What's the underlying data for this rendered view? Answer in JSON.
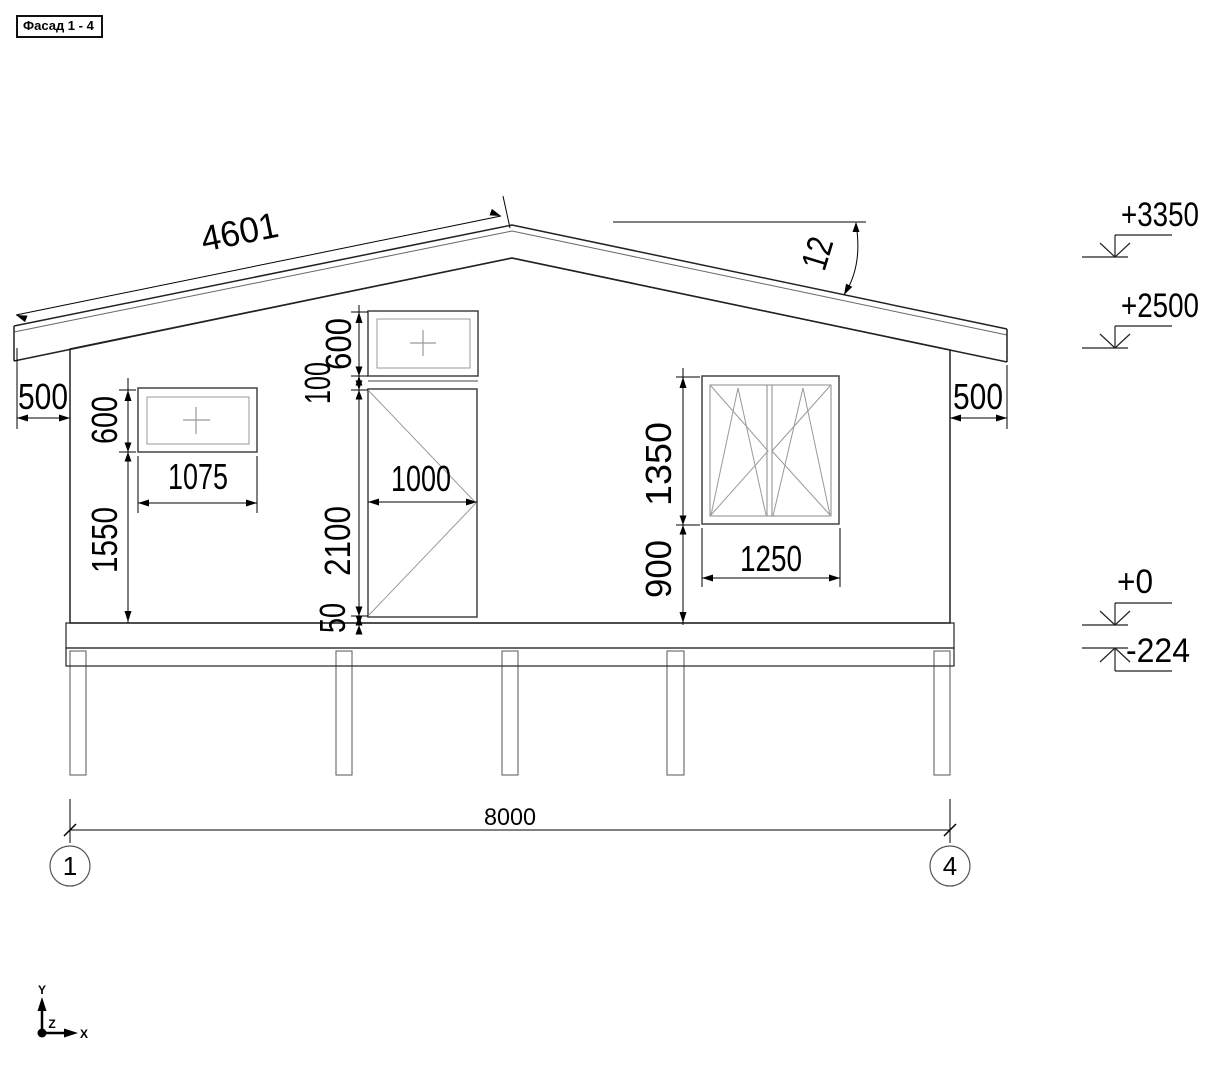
{
  "title": "Фасад 1 - 4",
  "colors": {
    "line": "#222222",
    "thin": "#8f8f8f",
    "dim": "#000000",
    "background": "#ffffff"
  },
  "dims": {
    "roof_slope": "4601",
    "roof_angle": "12",
    "eave_left": "500",
    "eave_right": "500",
    "overall_width": "8000",
    "left_window": {
      "height": "600",
      "width": "1075",
      "sill_height": "1550"
    },
    "door": {
      "transom_height": "600",
      "transom_gap": "100",
      "height": "2100",
      "width": "1000",
      "floor_gap": "50"
    },
    "right_window": {
      "height": "1350",
      "width": "1250",
      "sill_height": "900"
    }
  },
  "levels": {
    "roof_ridge": "+3350",
    "roof_eave": "+2500",
    "floor": "+0",
    "underfloor": "-224"
  },
  "axes": {
    "left": "1",
    "right": "4"
  },
  "ucs": {
    "x_label": "X",
    "y_label": "Y",
    "z_label": "Z"
  }
}
